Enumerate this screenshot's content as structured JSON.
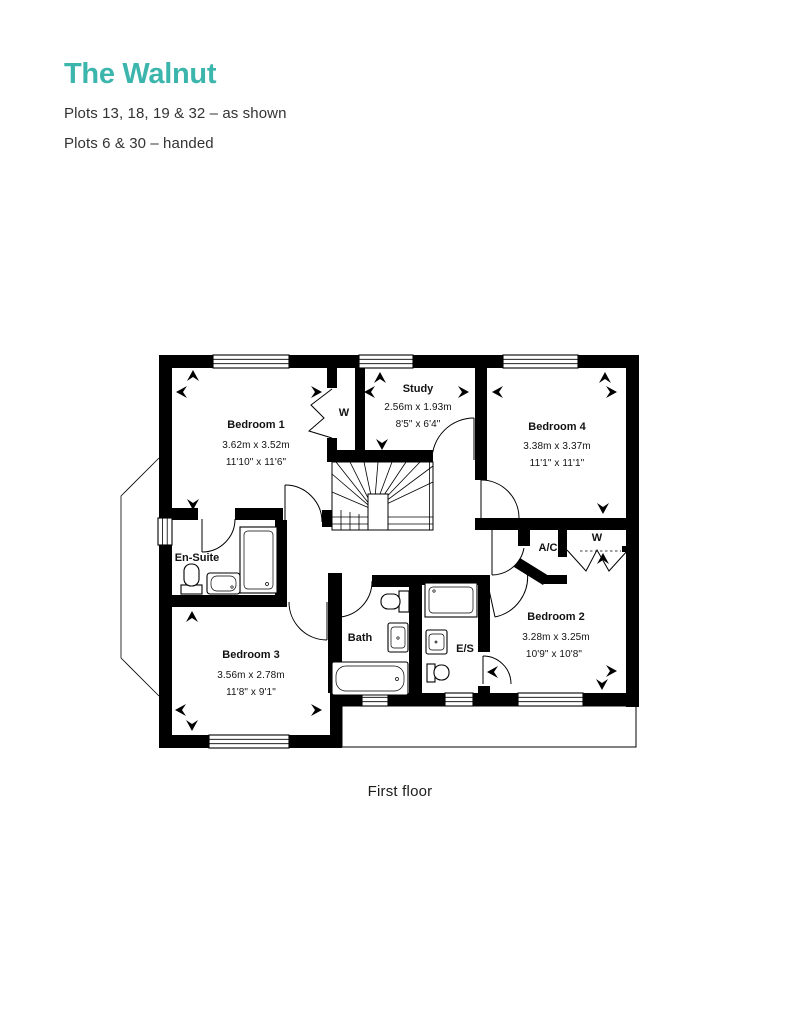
{
  "header": {
    "title": "The Walnut",
    "plots_as_shown": "Plots 13, 18, 19 & 32 – as shown",
    "plots_handed": "Plots 6 & 30 – handed",
    "title_color": "#3CB5AC"
  },
  "floorplan": {
    "caption": "First floor",
    "wall_color": "#000000",
    "rooms": {
      "bedroom1": {
        "name": "Bedroom 1",
        "metric": "3.62m x 3.52m",
        "imperial": "11'10\" x 11'6\""
      },
      "study": {
        "name": "Study",
        "metric": "2.56m x 1.93m",
        "imperial": "8'5\" x 6'4\""
      },
      "bedroom4": {
        "name": "Bedroom 4",
        "metric": "3.38m x 3.37m",
        "imperial": "11'1\" x 11'1\""
      },
      "ensuite": {
        "name": "En-Suite"
      },
      "bedroom3": {
        "name": "Bedroom 3",
        "metric": "3.56m x 2.78m",
        "imperial": "11'8\" x 9'1\""
      },
      "bath": {
        "name": "Bath"
      },
      "es": {
        "name": "E/S"
      },
      "bedroom2": {
        "name": "Bedroom 2",
        "metric": "3.28m x 3.25m",
        "imperial": "10'9\" x 10'8\""
      },
      "ac": {
        "name": "A/C"
      },
      "wardrobe": {
        "name": "W"
      }
    }
  }
}
